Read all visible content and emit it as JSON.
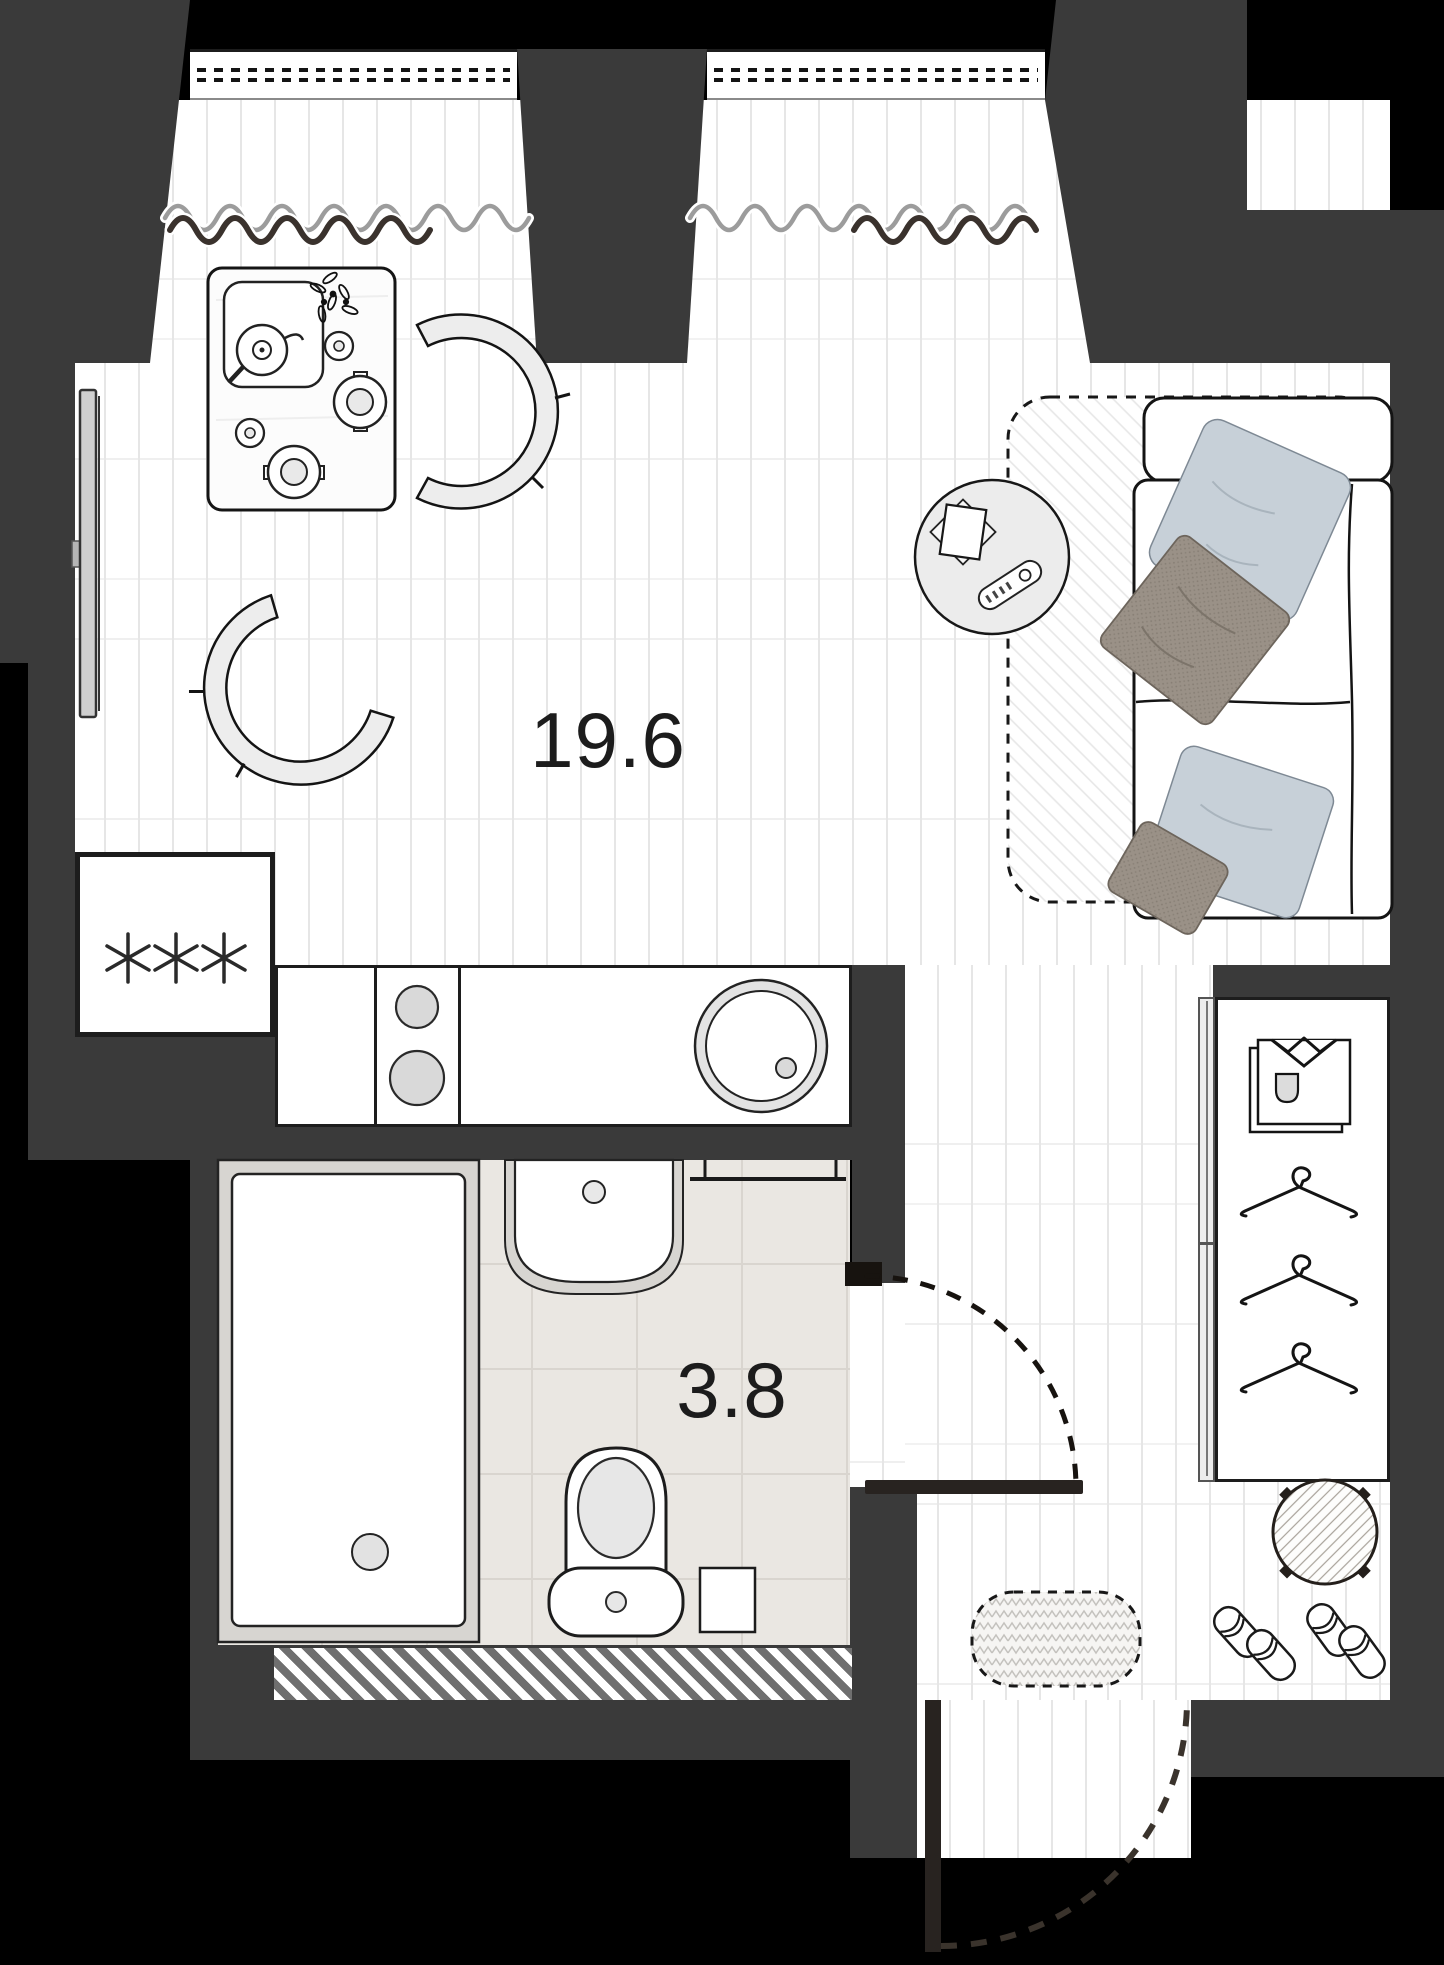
{
  "plan": {
    "rooms": {
      "main": {
        "area_label": "19.6"
      },
      "bathroom": {
        "area_label": "3.8"
      }
    },
    "colors": {
      "outside": "#000000",
      "wall": "#3a3a3a",
      "floor": "#ffffff",
      "floor_line": "#e6e6e6",
      "tile": "#eae7e2",
      "tile_line": "#d9d5cf",
      "outline": "#1a1a1a",
      "fixture_gray": "#d9d9d9",
      "pillow_blue": "#c7d0d8",
      "pillow_brown": "#9a9187",
      "curtain_light": "#9c9c9c",
      "curtain_dark": "#3a322d"
    },
    "icons": {
      "fridge": "three-asterisk-fridge-icon",
      "hob": "two-burner-hob-icon",
      "kitchen_sink": "round-sink-icon",
      "tv": "wall-tv-icon",
      "sofa": "sofa-with-pillows-icon",
      "coffee_table": "round-coffee-table-icon",
      "remote": "remote-control-icon",
      "dining_table": "dining-table-icon",
      "chairs": "armchair-icon",
      "wardrobe": "wardrobe-with-shirt-and-hangers-icon",
      "pouf": "round-pouf-icon",
      "slippers": "slippers-icon",
      "bathtub": "bathtub-icon",
      "bath_sink": "wall-sink-icon",
      "toilet": "toilet-icon",
      "towel_rail": "towel-rail-icon",
      "doors": "door-swing-arc-icon",
      "rugs": "rug-icon",
      "curtains": "curtain-wave-icon"
    }
  }
}
